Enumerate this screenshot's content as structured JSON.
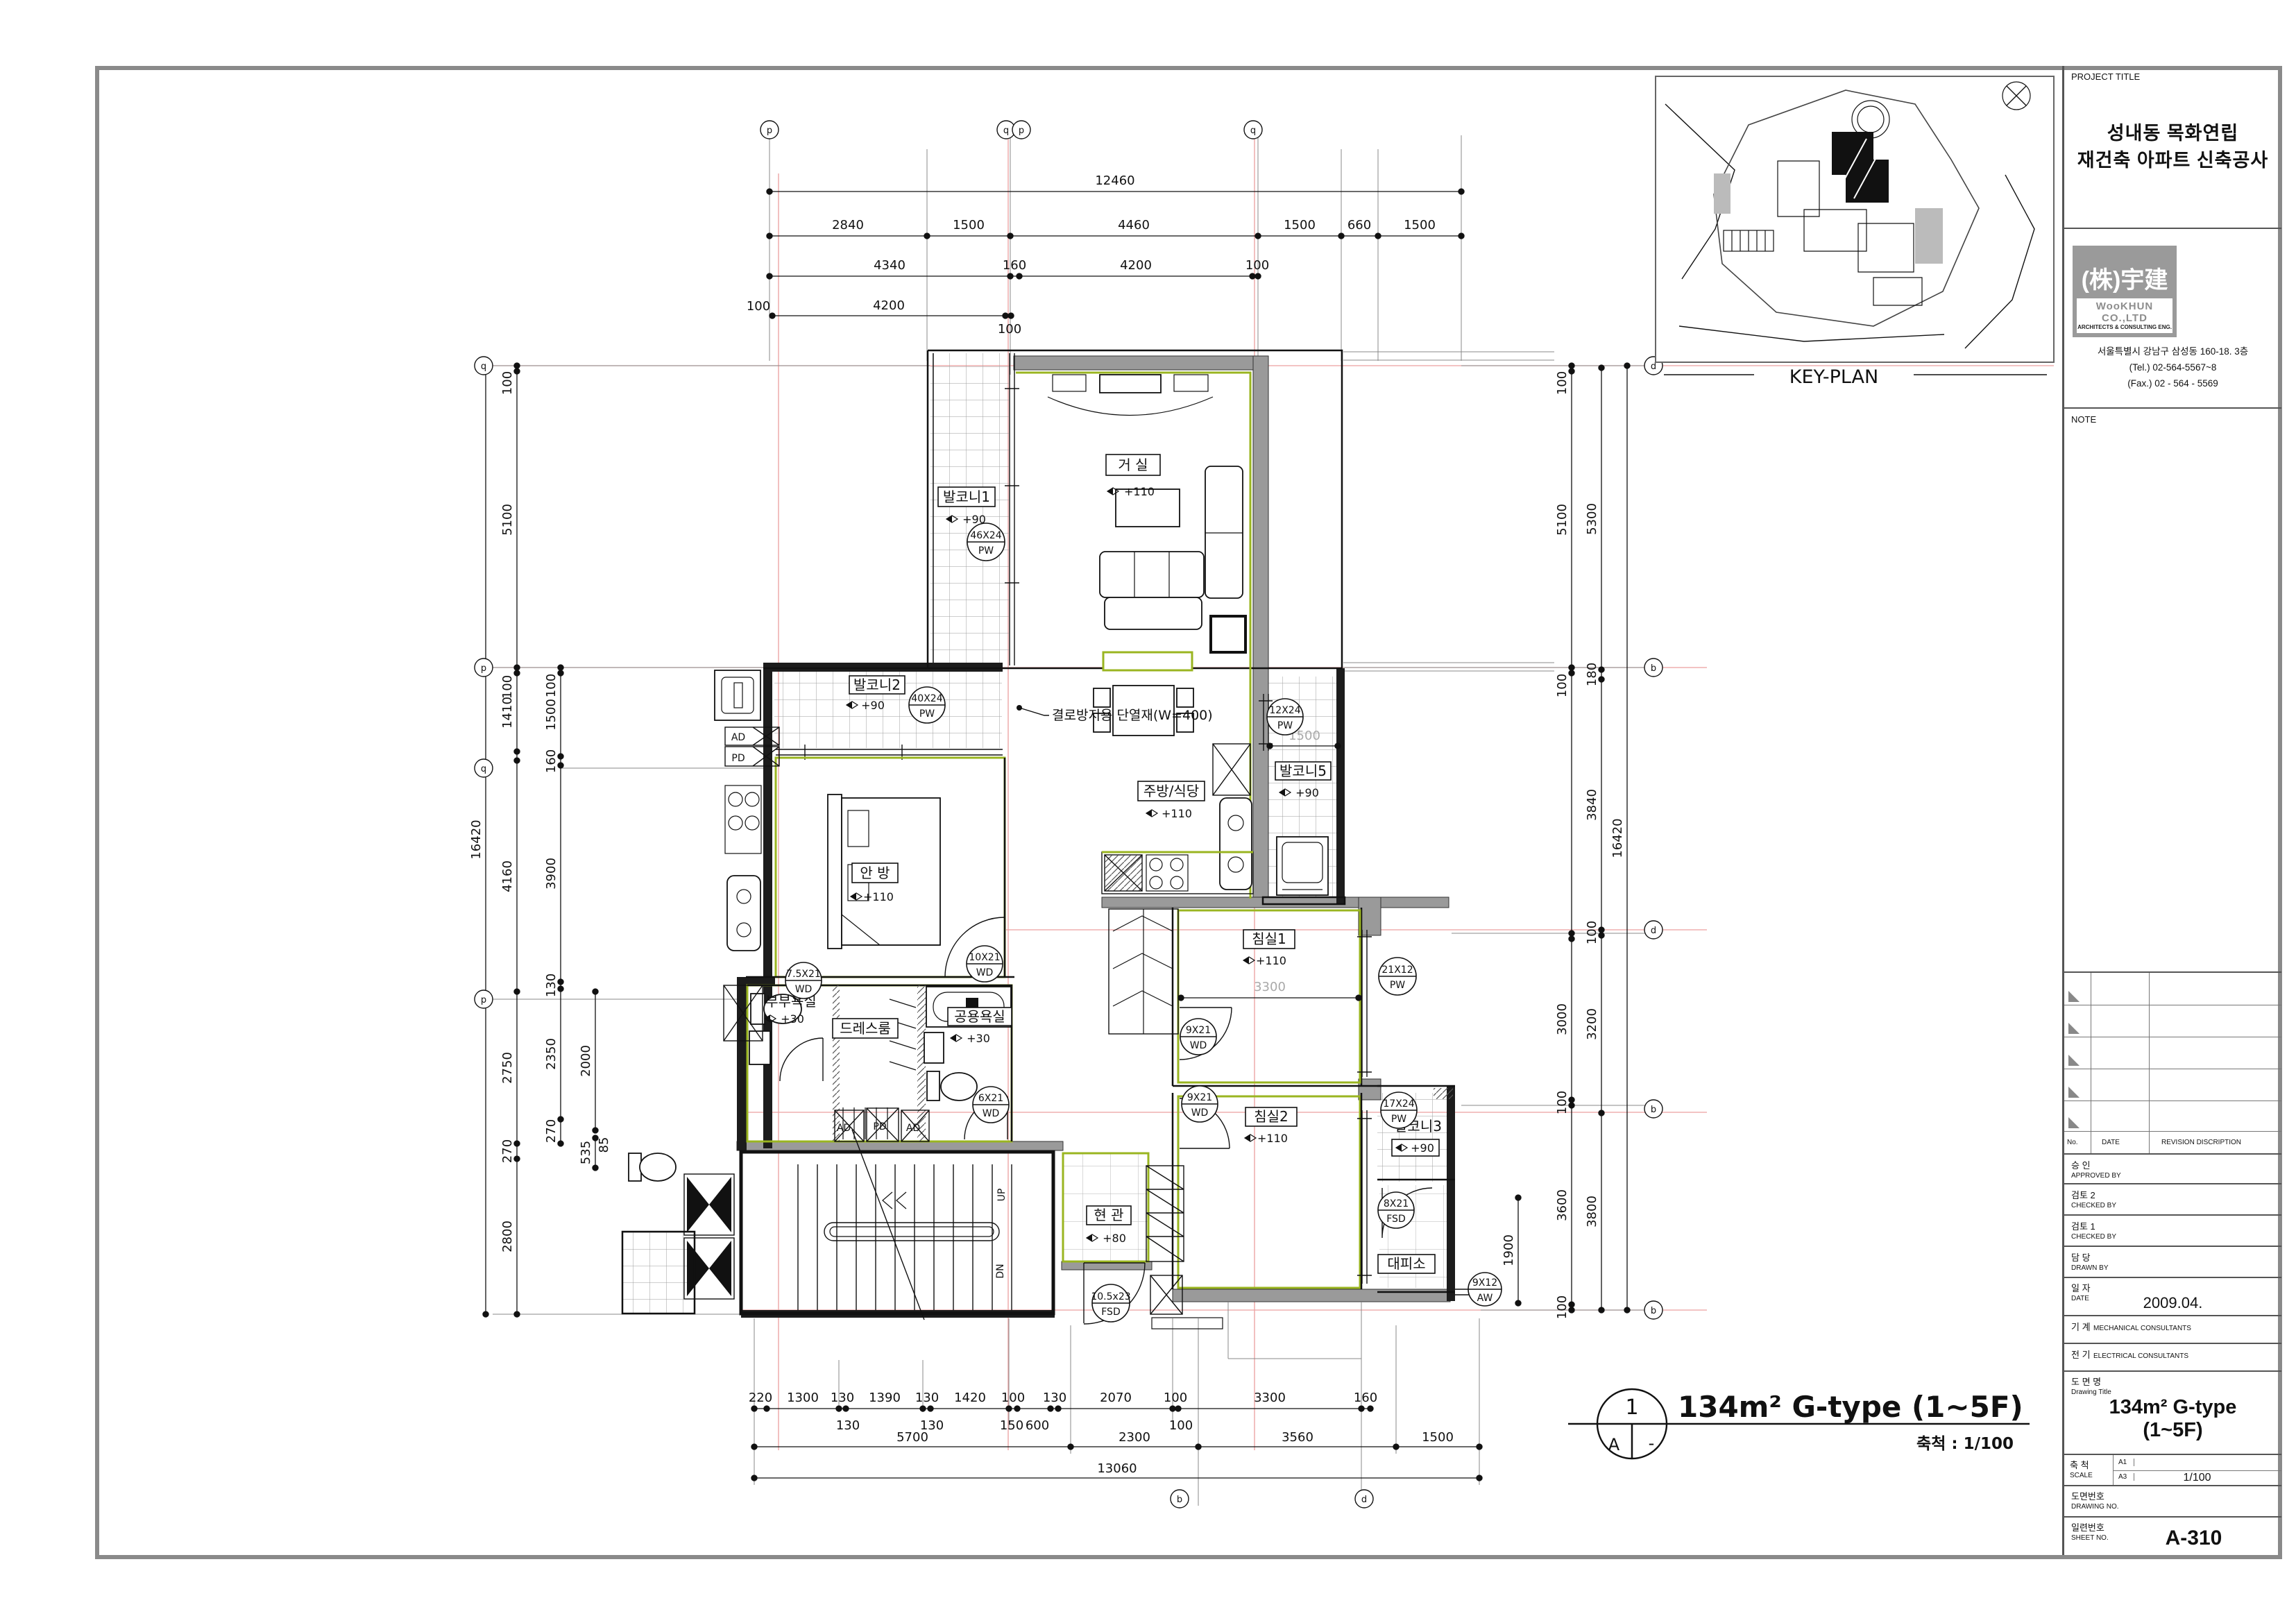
{
  "title_block": {
    "project_label": "PROJECT TITLE",
    "project_line1": "성내동 목화연립",
    "project_line2": "재건축 아파트 신축공사",
    "logo_mark": "(株)宇建",
    "logo_name": "WooKHUN CO.,LTD",
    "logo_sub": "ARCHITECTS & CONSULTING ENG.",
    "address": "서울특별시 강남구 삼성동 160-18. 3층",
    "tel": "(Tel.) 02-564-5567~8",
    "fax": "(Fax.) 02 - 564 - 5569",
    "note": "NOTE",
    "rev_no": "No.",
    "rev_date": "DATE",
    "rev_desc": "REVISION DISCRIPTION",
    "approved_kr": "승 인",
    "approved_en": "APPROVED BY",
    "checked2_kr": "검토 2",
    "checked2_en": "CHECKED BY",
    "checked1_kr": "검토 1",
    "checked1_en": "CHECKED BY",
    "drawn_kr": "담 당",
    "drawn_en": "DRAWN BY",
    "date_kr": "일 자",
    "date_en": "DATE",
    "date_value": "2009.04.",
    "mech_kr": "기 계",
    "mech_en": "MECHANICAL CONSULTANTS",
    "elec_kr": "전 기",
    "elec_en": "ELECTRICAL CONSULTANTS",
    "dwg_title_kr": "도 면 명",
    "dwg_title_en": "Drawing Title",
    "dwg_title_l1": "134m² G-type",
    "dwg_title_l2": "(1~5F)",
    "scale_kr": "축 척",
    "scale_en": "SCALE",
    "scale_a1": "A1",
    "scale_a3": "A3",
    "scale_val": "1/100",
    "dwgno_kr": "도면번호",
    "dwgno_en": "DRAWING NO.",
    "sheet_kr": "일련번호",
    "sheet_en": "SHEET NO.",
    "sheet_val": "A-310"
  },
  "key_plan": {
    "label": "KEY-PLAN"
  },
  "caption": {
    "num": "1",
    "letter": "A",
    "dash": "-",
    "title": "134m² G-type (1~5F)",
    "scale": "축척 : 1/100"
  },
  "rooms": {
    "living": {
      "name": "거 실",
      "level": "+110"
    },
    "bal1": {
      "name": "발코니1",
      "level": "+90"
    },
    "bal2": {
      "name": "발코니2",
      "level": "+90"
    },
    "bal5": {
      "name": "발코니5",
      "level": "+90"
    },
    "kitchen": {
      "name": "주방/식당",
      "level": "+110"
    },
    "master": {
      "name": "안 방",
      "level": "+110"
    },
    "bed1": {
      "name": "침실1",
      "level": "+110"
    },
    "bed2": {
      "name": "침실2",
      "level": "+110"
    },
    "bal3": {
      "name": "발코니3",
      "level": "+90"
    },
    "shelter": {
      "name": "대피소"
    },
    "couple": {
      "name": "부부욕실",
      "level": "+30"
    },
    "dress": {
      "name": "드레스룸"
    },
    "common": {
      "name": "공용욕실",
      "level": "+30"
    },
    "entry": {
      "name": "현 관",
      "level": "+80"
    }
  },
  "tags": {
    "bal1": {
      "size": "46X24",
      "type": "PW"
    },
    "bal2": {
      "size": "40X24",
      "type": "PW"
    },
    "bal5": {
      "size": "12X24",
      "type": "PW"
    },
    "bed1w": {
      "size": "21X12",
      "type": "PW"
    },
    "bal3": {
      "size": "17X24",
      "type": "PW"
    },
    "shelw": {
      "size": "9X12",
      "type": "AW"
    },
    "master": {
      "size": "10X21",
      "type": "WD"
    },
    "couple": {
      "size": "7.5X21",
      "type": "WD"
    },
    "common": {
      "size": "6X21",
      "type": "WD"
    },
    "bed1": {
      "size": "9X21",
      "type": "WD"
    },
    "bed2": {
      "size": "9X21",
      "type": "WD"
    },
    "shelter": {
      "size": "8X21",
      "type": "FSD"
    },
    "entry": {
      "size": "10.5x23",
      "type": "FSD"
    }
  },
  "misc": {
    "up": "UP",
    "dn": "DN",
    "ad": "AD",
    "pd": "PD",
    "annotation": "결로방지용 단열재(W=400)"
  },
  "dims": {
    "top1": [
      "12460"
    ],
    "top2": [
      "2840",
      "1500",
      "4460",
      "1500",
      "660",
      "1500"
    ],
    "top3": [
      "4340",
      "160",
      "4200",
      "100"
    ],
    "top4": [
      "100",
      "4200",
      "100"
    ],
    "bot1": [
      "220",
      "1300",
      "130",
      "1390",
      "130",
      "1420",
      "100",
      "130",
      "2070",
      "100",
      "3300",
      "160"
    ],
    "bot1b": [
      "130",
      "130",
      "150",
      "600",
      "100"
    ],
    "bot2": [
      "5700",
      "2300",
      "3560",
      "1500"
    ],
    "bot3": [
      "13060"
    ],
    "left_outer": [
      "16420"
    ],
    "left_mid": [
      "100",
      "5100",
      "100",
      "1410",
      "4160",
      "2750",
      "270",
      "2800"
    ],
    "left_in": [
      "100",
      "1500",
      "160",
      "3900",
      "130",
      "2350",
      "270"
    ],
    "left_in2": [
      "2000",
      "535",
      "85"
    ],
    "right_in": [
      "100",
      "5100",
      "100",
      "3000",
      "100",
      "3600",
      "100"
    ],
    "right_mid": [
      "5300",
      "180",
      "3840",
      "100",
      "3200",
      "3800"
    ],
    "right_outer": [
      "16420"
    ],
    "gray_bed1": "3300",
    "gray_bal5": "1500",
    "shelter_dim": "1900"
  },
  "grid": {
    "top": [
      "p",
      "q",
      "p",
      "q"
    ],
    "left": [
      "q",
      "p",
      "q",
      "p"
    ],
    "right": [
      "d",
      "b",
      "d",
      "b",
      "b"
    ],
    "bottom": [
      "b",
      "d"
    ]
  }
}
